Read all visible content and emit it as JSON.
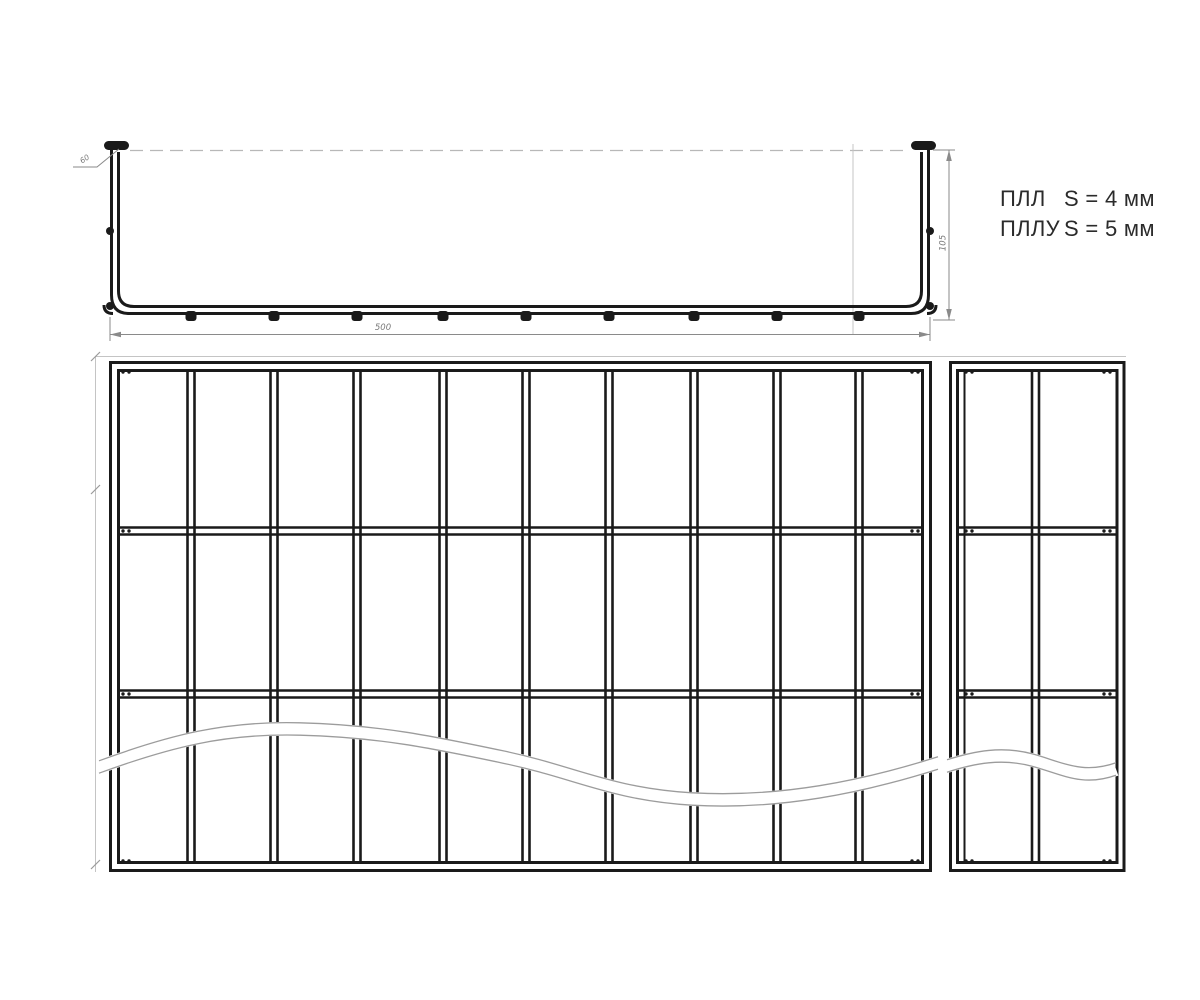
{
  "spec": {
    "line1": {
      "label": "ПЛЛ",
      "value": "S = 4 мм"
    },
    "line2": {
      "label": "ПЛЛУ",
      "value": "S = 5 мм"
    }
  },
  "dimensions": {
    "bottom_width": "500",
    "right_height": "105",
    "corner_callout": "60"
  },
  "colors": {
    "line": "#1a1a1a",
    "thin": "#c4c4c4",
    "dim": "#8a8a8a",
    "dim_text": "#7a7a7a",
    "band_edge": "#9c9c9c",
    "text": "#2b2b2b"
  },
  "drawing": {
    "side_view": {
      "rivet_ys": [
        231,
        306
      ],
      "tab_y": 311
    },
    "main_grid": {
      "rung_xs": [
        191,
        274,
        357,
        443,
        526,
        609,
        694,
        777,
        859
      ],
      "member_ys": [
        531,
        694
      ],
      "inner": {
        "x1": 120,
        "x2": 921,
        "y1": 372,
        "y2": 861
      },
      "dot_xs": [
        123,
        129,
        912,
        918
      ],
      "dot_ys": [
        372,
        531,
        694,
        861
      ]
    },
    "end_grid": {
      "rung_xs": [
        1035.5
      ],
      "member_ys": [
        531,
        694
      ],
      "inner": {
        "x1": 959,
        "x2": 1116,
        "y1": 372,
        "y2": 861
      },
      "dot_xs": [
        966,
        972,
        1104,
        1110
      ],
      "dot_ys": [
        372,
        531,
        694,
        861
      ]
    }
  }
}
